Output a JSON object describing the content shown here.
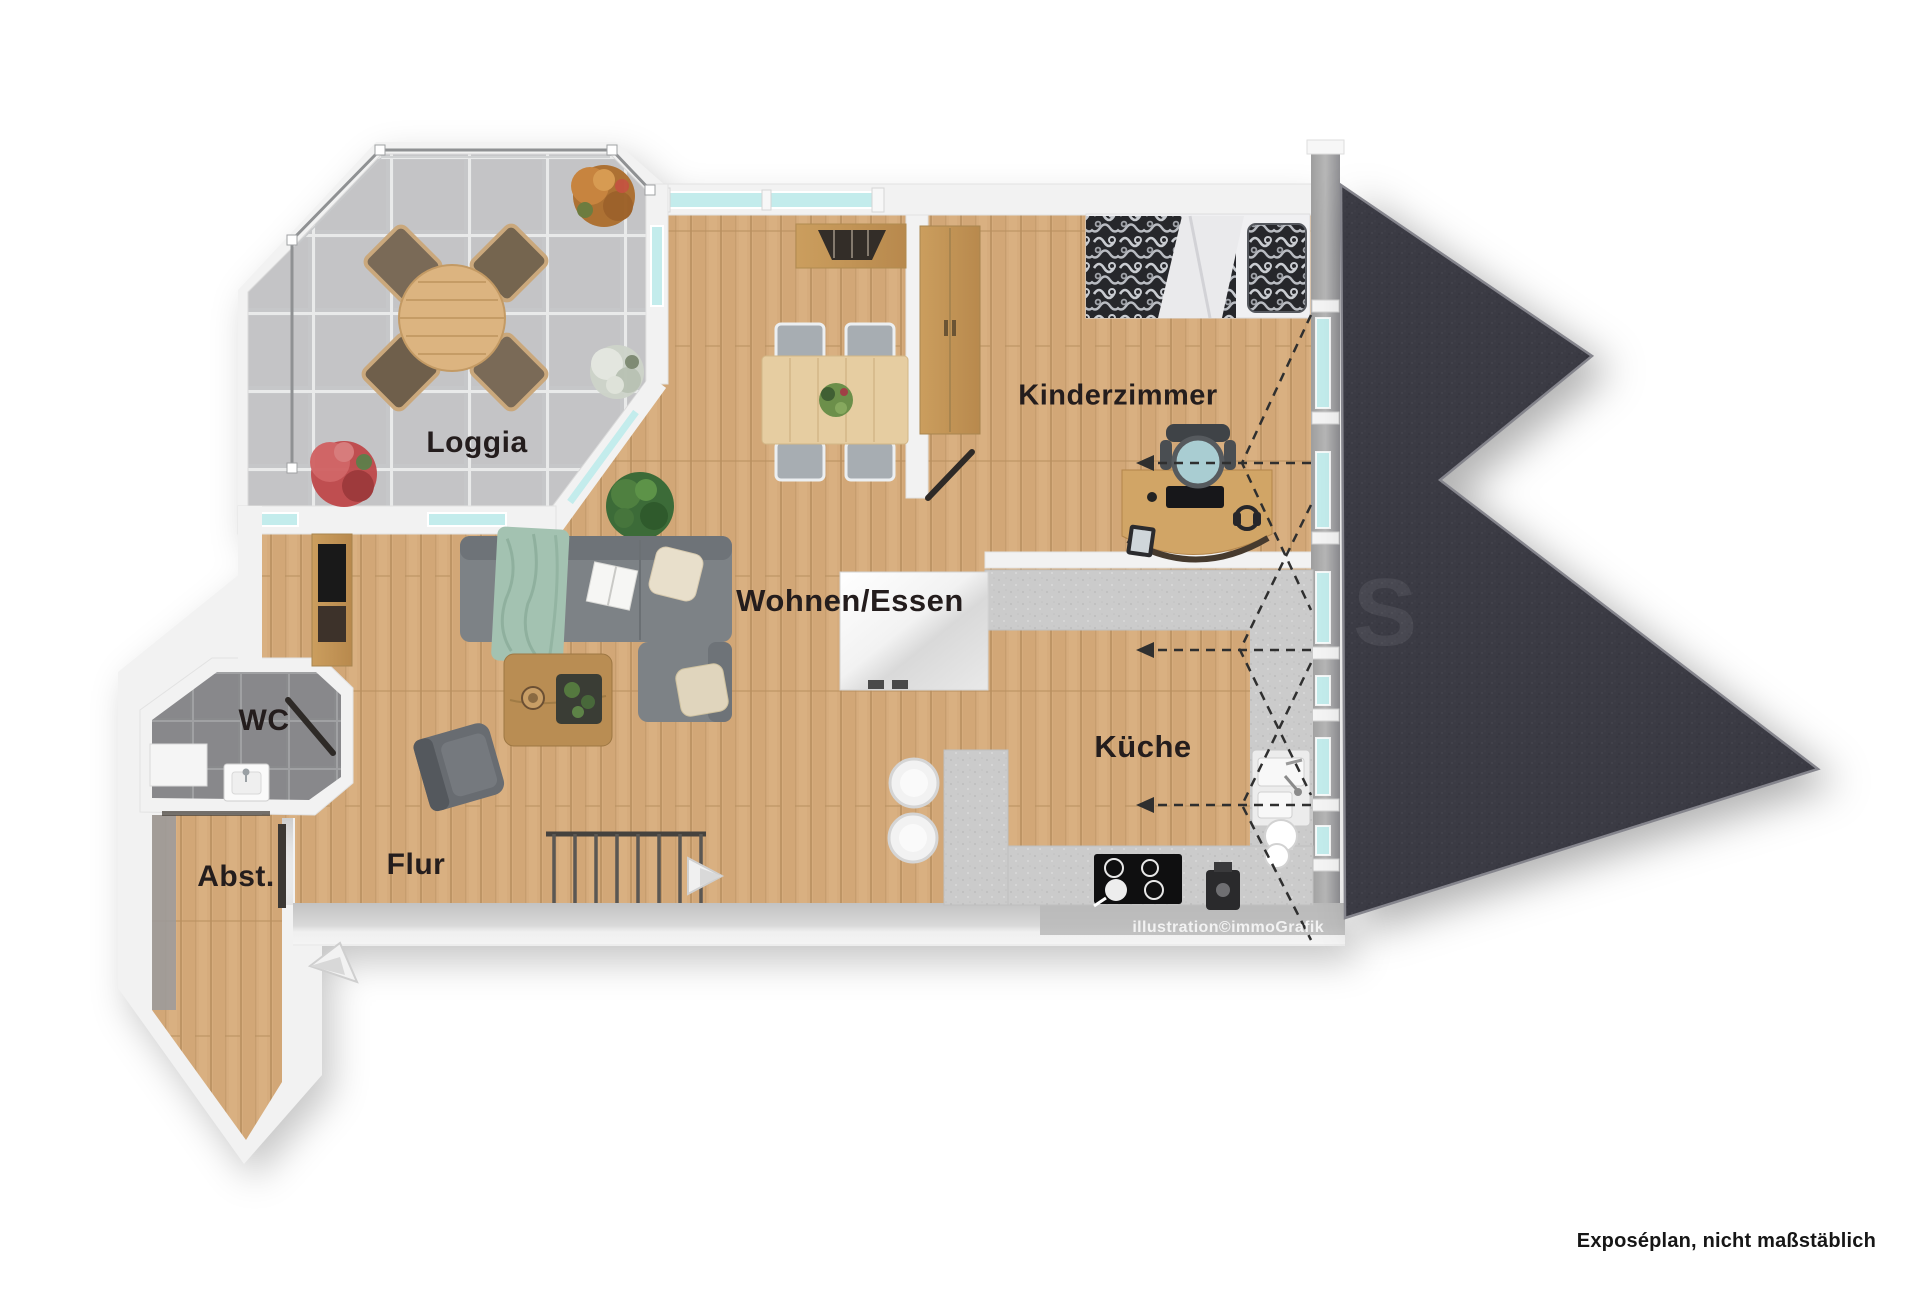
{
  "document": {
    "type": "floor-plan-rendering"
  },
  "rooms": {
    "loggia": "Loggia",
    "wohnen_essen": "Wohnen/Essen",
    "kinderzimmer": "Kinderzimmer",
    "kueche": "Küche",
    "wc": "WC",
    "abstellraum": "Abst.",
    "flur": "Flur"
  },
  "annotations": {
    "credit": "illustration©immoGrafik",
    "disclaimer": "Exposéplan, nicht maßstäblich",
    "roof_watermark": "S"
  },
  "colors": {
    "wood": "#d5ab7c",
    "loggia_tile": "#c7c8ca",
    "wc_tile": "#8b8c8e",
    "wall": "#f2f2f2",
    "roof": "#3b3b44",
    "glass": "#c3ecec",
    "counter": "#cccccc",
    "label_text": "#241d1d"
  }
}
